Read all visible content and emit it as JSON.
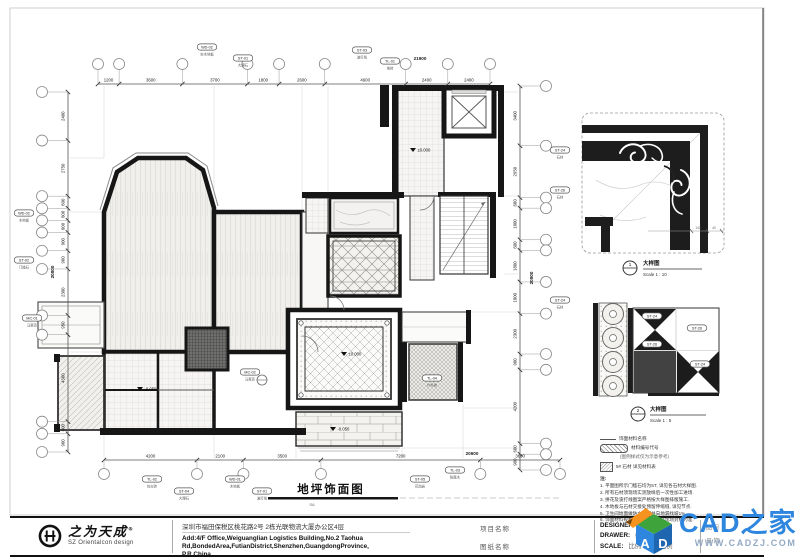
{
  "sheet": {
    "bg": "#ffffff",
    "ink": "#161616",
    "accent_blue": "#2E86DE"
  },
  "title": {
    "main": "地坪饰面图",
    "code": "SA"
  },
  "plan": {
    "dims": {
      "top": {
        "values": [
          "1200",
          "3600",
          "3700",
          "1800",
          "2600",
          "4600",
          "2400",
          "2400"
        ],
        "total": "21900"
      },
      "bottom": {
        "values": [
          "4200",
          "2100",
          "3500",
          "7200",
          "3600"
        ],
        "total": "20600"
      },
      "left": {
        "values": [
          "2400",
          "2750",
          "600",
          "600",
          "600",
          "900",
          "900",
          "2300",
          "950",
          "4300",
          "600",
          "900"
        ],
        "total": "20800"
      },
      "right": {
        "values": [
          "3400",
          "2950",
          "600",
          "1800",
          "600",
          "1800",
          "1800",
          "2300",
          "900",
          "4200",
          "600",
          "900"
        ],
        "total": "20800"
      }
    },
    "levels": [
      {
        "x": 344,
        "y": 356,
        "label": "±0.000"
      },
      {
        "x": 413,
        "y": 152,
        "label": "±0.000"
      },
      {
        "x": 333,
        "y": 431,
        "label": "-0.050"
      },
      {
        "x": 140,
        "y": 391,
        "label": "-0.050"
      }
    ],
    "tags": [
      {
        "x": 207,
        "y": 47,
        "code": "WD-02",
        "name": "实木地板"
      },
      {
        "x": 243,
        "y": 58,
        "code": "ST-01",
        "name": "大理石"
      },
      {
        "x": 362,
        "y": 50,
        "code": "ST-03",
        "name": "波打线"
      },
      {
        "x": 390,
        "y": 61,
        "code": "TL-01",
        "name": "地砖"
      },
      {
        "x": 24,
        "y": 213,
        "code": "WD-02",
        "name": "木地板"
      },
      {
        "x": 24,
        "y": 260,
        "code": "ST-02",
        "name": "门槛石"
      },
      {
        "x": 32,
        "y": 318,
        "code": "MC-01",
        "name": "马赛克"
      },
      {
        "x": 152,
        "y": 479,
        "code": "TL-02",
        "name": "仿古砖"
      },
      {
        "x": 184,
        "y": 491,
        "code": "ST-04",
        "name": "大理石"
      },
      {
        "x": 235,
        "y": 479,
        "code": "WD-01",
        "name": "木地板"
      },
      {
        "x": 262,
        "y": 491,
        "code": "ST-01",
        "name": "波打线"
      },
      {
        "x": 420,
        "y": 479,
        "code": "ST-05",
        "name": "花岗岩"
      },
      {
        "x": 455,
        "y": 470,
        "code": "TL-03",
        "name": "防腐木"
      },
      {
        "x": 560,
        "y": 150,
        "code": "ST-24",
        "name": "石材"
      },
      {
        "x": 560,
        "y": 190,
        "code": "ST-26",
        "name": "石材"
      },
      {
        "x": 560,
        "y": 300,
        "code": "ST-24",
        "name": "石材"
      },
      {
        "x": 432,
        "y": 378,
        "code": "TL-04",
        "name": "户外砖"
      },
      {
        "x": 250,
        "y": 372,
        "code": "MC-02",
        "name": "马赛克"
      },
      {
        "x": 652,
        "y": 316,
        "code": "ST-24",
        "name": ""
      },
      {
        "x": 652,
        "y": 344,
        "code": "ST-26",
        "name": ""
      },
      {
        "x": 697,
        "y": 328,
        "code": "ST-26",
        "name": ""
      },
      {
        "x": 700,
        "y": 364,
        "code": "ST-24",
        "name": ""
      }
    ]
  },
  "details": {
    "d1": {
      "caption": "大样图",
      "scale_label": "Scale 1 : 10",
      "ref": "1",
      "subdims": [
        "140",
        "40"
      ]
    },
    "d2": {
      "caption": "大样图",
      "scale_label": "Scale 1 : 5",
      "ref": "2"
    }
  },
  "legend": {
    "l1": "饰面材料名称",
    "l2": "材料编号代号",
    "l3": "(图例样式仅为示意参考)",
    "l4": "5# 石材 详见材料表"
  },
  "notes": {
    "heading": "注:",
    "items": [
      "1. 平面图所示门槛石均为ST, 详见各石材大样图.",
      "2. 所有石材须现场实测放样后一次性加工进场.",
      "3. 拼花及波打线图案严格按大样图排版施工.",
      "4. 木地板与石材交接处预留伸缩缝, 详见节点.",
      "5. 卫生间地面做防水处理并向地漏找坡1%.",
      "6. 饰面材料规格颜色以材料表及现场封样为准."
    ]
  },
  "titleblock": {
    "brand": "之为天成",
    "brand_reg": "®",
    "brand_sub": "SZ Orientalcon design",
    "address_cn": "深圳市福田保税区桃花路2号 2栋光联物流大厦办公区4层",
    "address_en_1": "Add:4/F Office,Weiguanglian Logistics Building,No.2 Taohua",
    "address_en_2": "Rd,BondedArea,FutianDistrict,Shenzhen,GuangdongProvince,",
    "address_en_3": "P.R.China",
    "project_label": "项目名称",
    "drawing_label": "图纸名称",
    "credits": [
      {
        "label": "DESIGNER:",
        "value": "设计"
      },
      {
        "label": "DRAWER:",
        "value": "绘图"
      },
      {
        "label": "SCALE:",
        "value": "比例　图纸比例"
      }
    ],
    "hidden_fields": [
      "图 号",
      "日 期"
    ]
  },
  "watermark": {
    "brand": "CAD之家",
    "url": "WWW.CADZJ.COM"
  }
}
